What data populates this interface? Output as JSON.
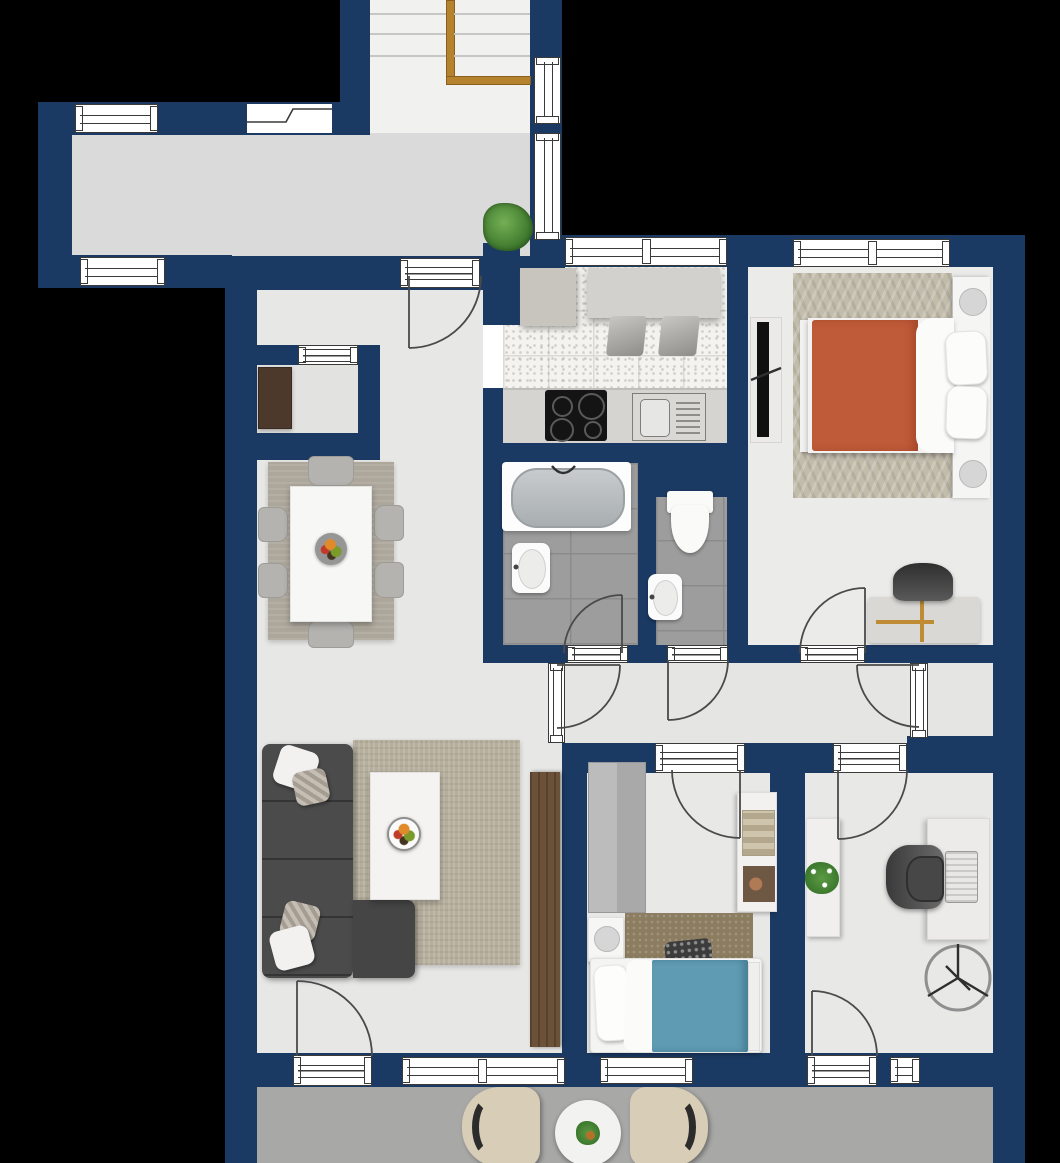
{
  "document": {
    "kind": "apartment floor plan drawing",
    "visible_text": []
  },
  "colors": {
    "wall": "#1b3a63",
    "frameline": "#3a3a3a",
    "arc": "#4a4a4a",
    "bg": "#000000",
    "floorhall": "#dadada",
    "floorstairs": "#f1f1f0",
    "floorroom": "#e7e7e6",
    "floorcorridor": "#e5e5e4",
    "floorbalcony": "#a8a8a7",
    "kitchentile": "#f4f3ef",
    "kitchengrid": "#dcdad4",
    "bathtile": "#9d9d9d",
    "bathgrid": "#8b8b8b",
    "rail": "#b5832e",
    "railedge": "#8a5f1c",
    "sofa": "#4b4b4b",
    "rugliving": "#b6af9e",
    "rugdining": "#aca69b",
    "rugbedroom": "#c2bcab",
    "rugchild": "#8c7c60",
    "bedorange": "#c05b39",
    "bedblue": "#5f9cb4",
    "wooddark": "#6b5138",
    "cabinetdark": "#4c392b",
    "counter": "#d6d4d0",
    "counter2": "#d2d1cd",
    "cooktop": "#141414",
    "whitefurn": "#f5f5f4",
    "grayfurn": "#b5b3af",
    "chairdark": "#4a4a4a",
    "beigechair": "#d8cdb6",
    "plantgreen": "#4e8f3a",
    "steel": "#9aa0a3",
    "lamp": "#d6d6d6"
  },
  "rooms": [
    {
      "name": "staircase-landing",
      "furniture": [
        {
          "item": "staircase",
          "count": 1
        },
        {
          "item": "handrail",
          "count": 1
        },
        {
          "item": "potted-plant",
          "count": 1
        }
      ]
    },
    {
      "name": "hallway-exterior",
      "furniture": []
    },
    {
      "name": "entry-dining-living-area",
      "furniture": [
        {
          "item": "storage-cabinet-dark",
          "count": 1
        },
        {
          "item": "dining-table",
          "count": 1
        },
        {
          "item": "dining-chair",
          "count": 6
        },
        {
          "item": "fruit-bowl",
          "count": 2
        },
        {
          "item": "corner-sofa",
          "count": 1
        },
        {
          "item": "throw-pillow",
          "count": 4
        },
        {
          "item": "coffee-table",
          "count": 1
        },
        {
          "item": "area-rug",
          "count": 2
        },
        {
          "item": "tall-wardrobe",
          "count": 1
        }
      ]
    },
    {
      "name": "kitchen",
      "furniture": [
        {
          "item": "corner-counter",
          "count": 1
        },
        {
          "item": "breakfast-bar",
          "count": 1
        },
        {
          "item": "bar-stool",
          "count": 2
        },
        {
          "item": "cooktop",
          "count": 1
        },
        {
          "item": "sink",
          "count": 1
        }
      ]
    },
    {
      "name": "bathroom",
      "furniture": [
        {
          "item": "bathtub",
          "count": 1
        },
        {
          "item": "washbasin",
          "count": 1
        }
      ]
    },
    {
      "name": "wc",
      "furniture": [
        {
          "item": "toilet",
          "count": 1
        },
        {
          "item": "washbasin",
          "count": 1
        }
      ]
    },
    {
      "name": "master-bedroom",
      "furniture": [
        {
          "item": "double-bed",
          "count": 1
        },
        {
          "item": "pillow",
          "count": 2
        },
        {
          "item": "nightstand-with-lamp",
          "count": 2
        },
        {
          "item": "rug",
          "count": 1
        },
        {
          "item": "tv-board",
          "count": 1
        },
        {
          "item": "desk",
          "count": 1
        },
        {
          "item": "chair",
          "count": 1
        }
      ]
    },
    {
      "name": "corridor",
      "furniture": []
    },
    {
      "name": "storage-closet",
      "furniture": []
    },
    {
      "name": "kids-bedroom",
      "furniture": [
        {
          "item": "wardrobe",
          "count": 1
        },
        {
          "item": "shelf-unit",
          "count": 1
        },
        {
          "item": "single-bed",
          "count": 1
        },
        {
          "item": "nightstand-with-lamp",
          "count": 1
        },
        {
          "item": "rug",
          "count": 1
        }
      ]
    },
    {
      "name": "office",
      "furniture": [
        {
          "item": "sideboard",
          "count": 1
        },
        {
          "item": "plant",
          "count": 1
        },
        {
          "item": "desk",
          "count": 1
        },
        {
          "item": "office-chair",
          "count": 1
        },
        {
          "item": "laptop",
          "count": 1
        },
        {
          "item": "ceiling-fan-symbol",
          "count": 1
        }
      ]
    },
    {
      "name": "balcony",
      "furniture": [
        {
          "item": "armchair",
          "count": 2
        },
        {
          "item": "round-table",
          "count": 1
        },
        {
          "item": "plant",
          "count": 1
        }
      ]
    }
  ]
}
